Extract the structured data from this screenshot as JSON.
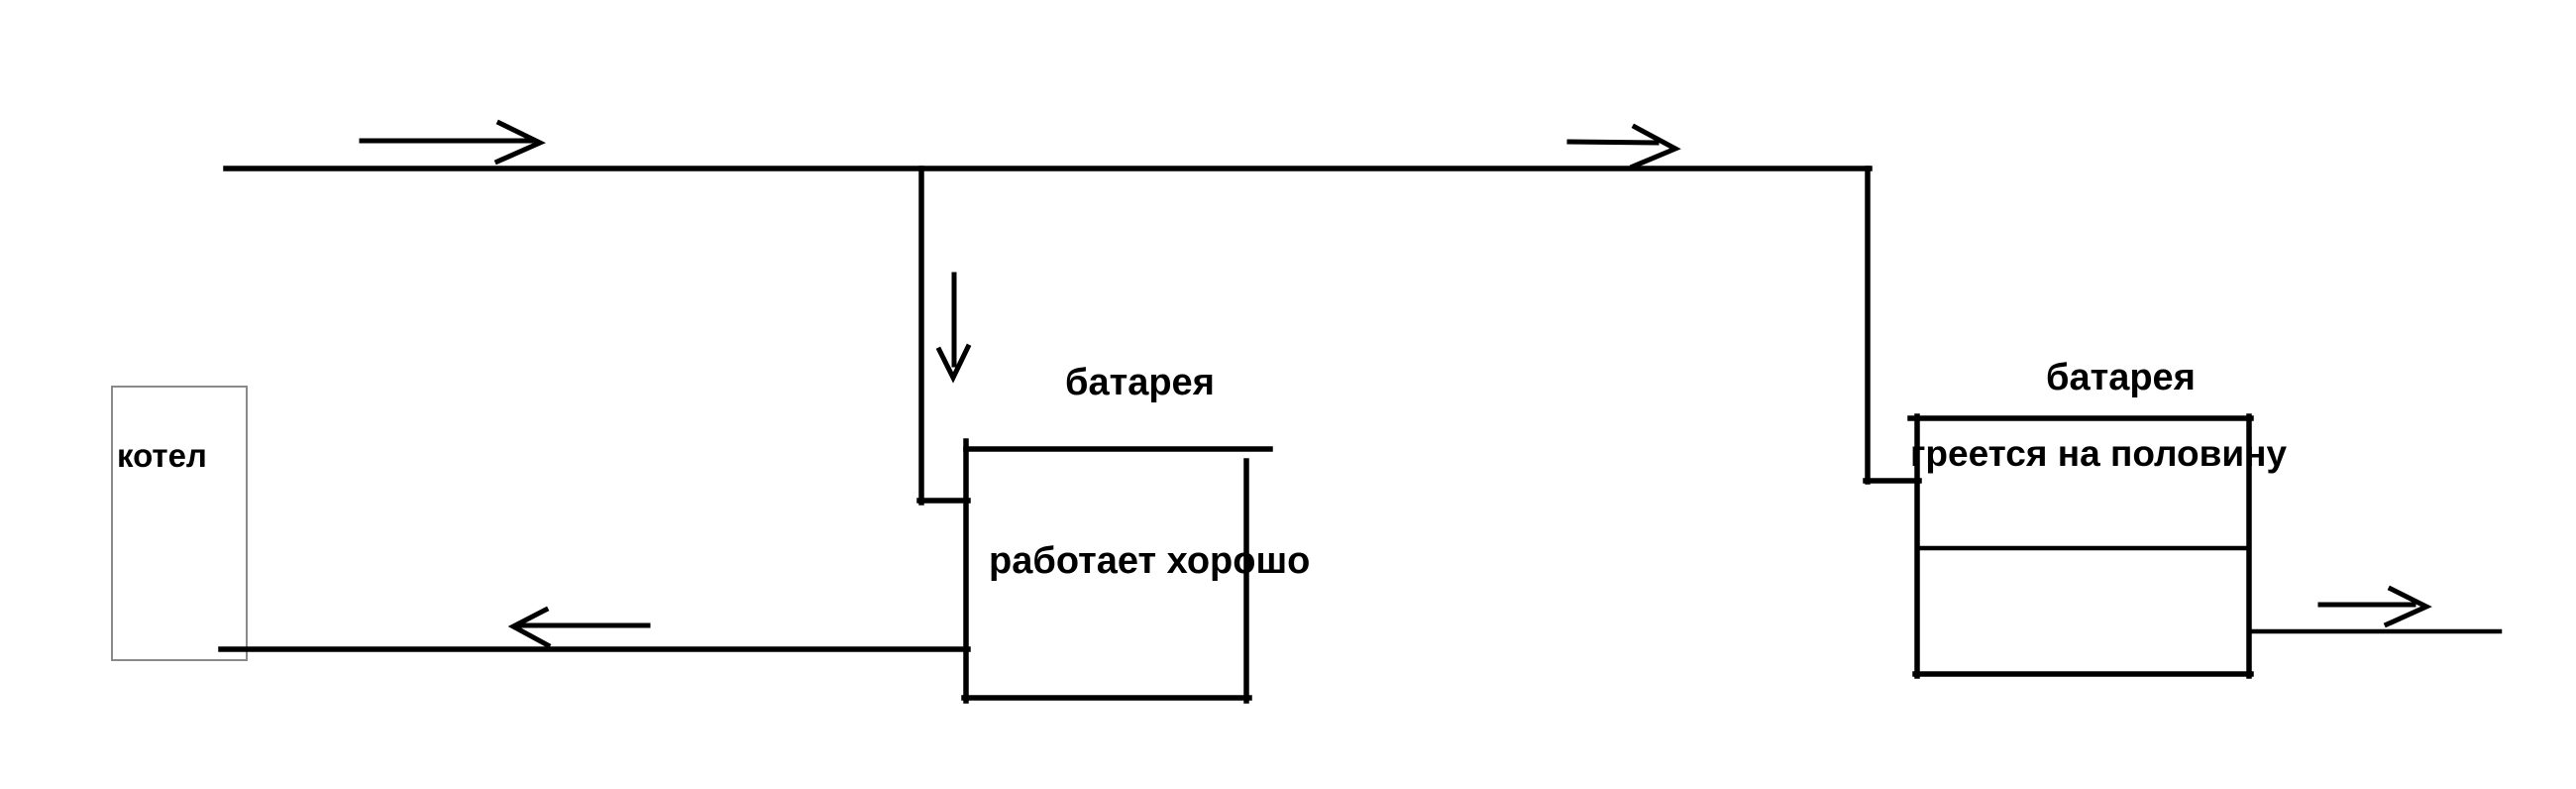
{
  "diagram": {
    "boiler": {
      "label": "котел"
    },
    "radiator_good": {
      "label": "батарея",
      "note": "работает хорошо"
    },
    "radiator_half": {
      "label": "батарея",
      "note": "греется на половину"
    },
    "icons": {
      "flow_right_arrow": "→",
      "flow_down_arrow": "↓",
      "flow_left_arrow": "←"
    },
    "colors": {
      "line": "#000000",
      "boiler_outline": "#8a8a8a",
      "text": "#000000",
      "background": "#ffffff"
    }
  }
}
